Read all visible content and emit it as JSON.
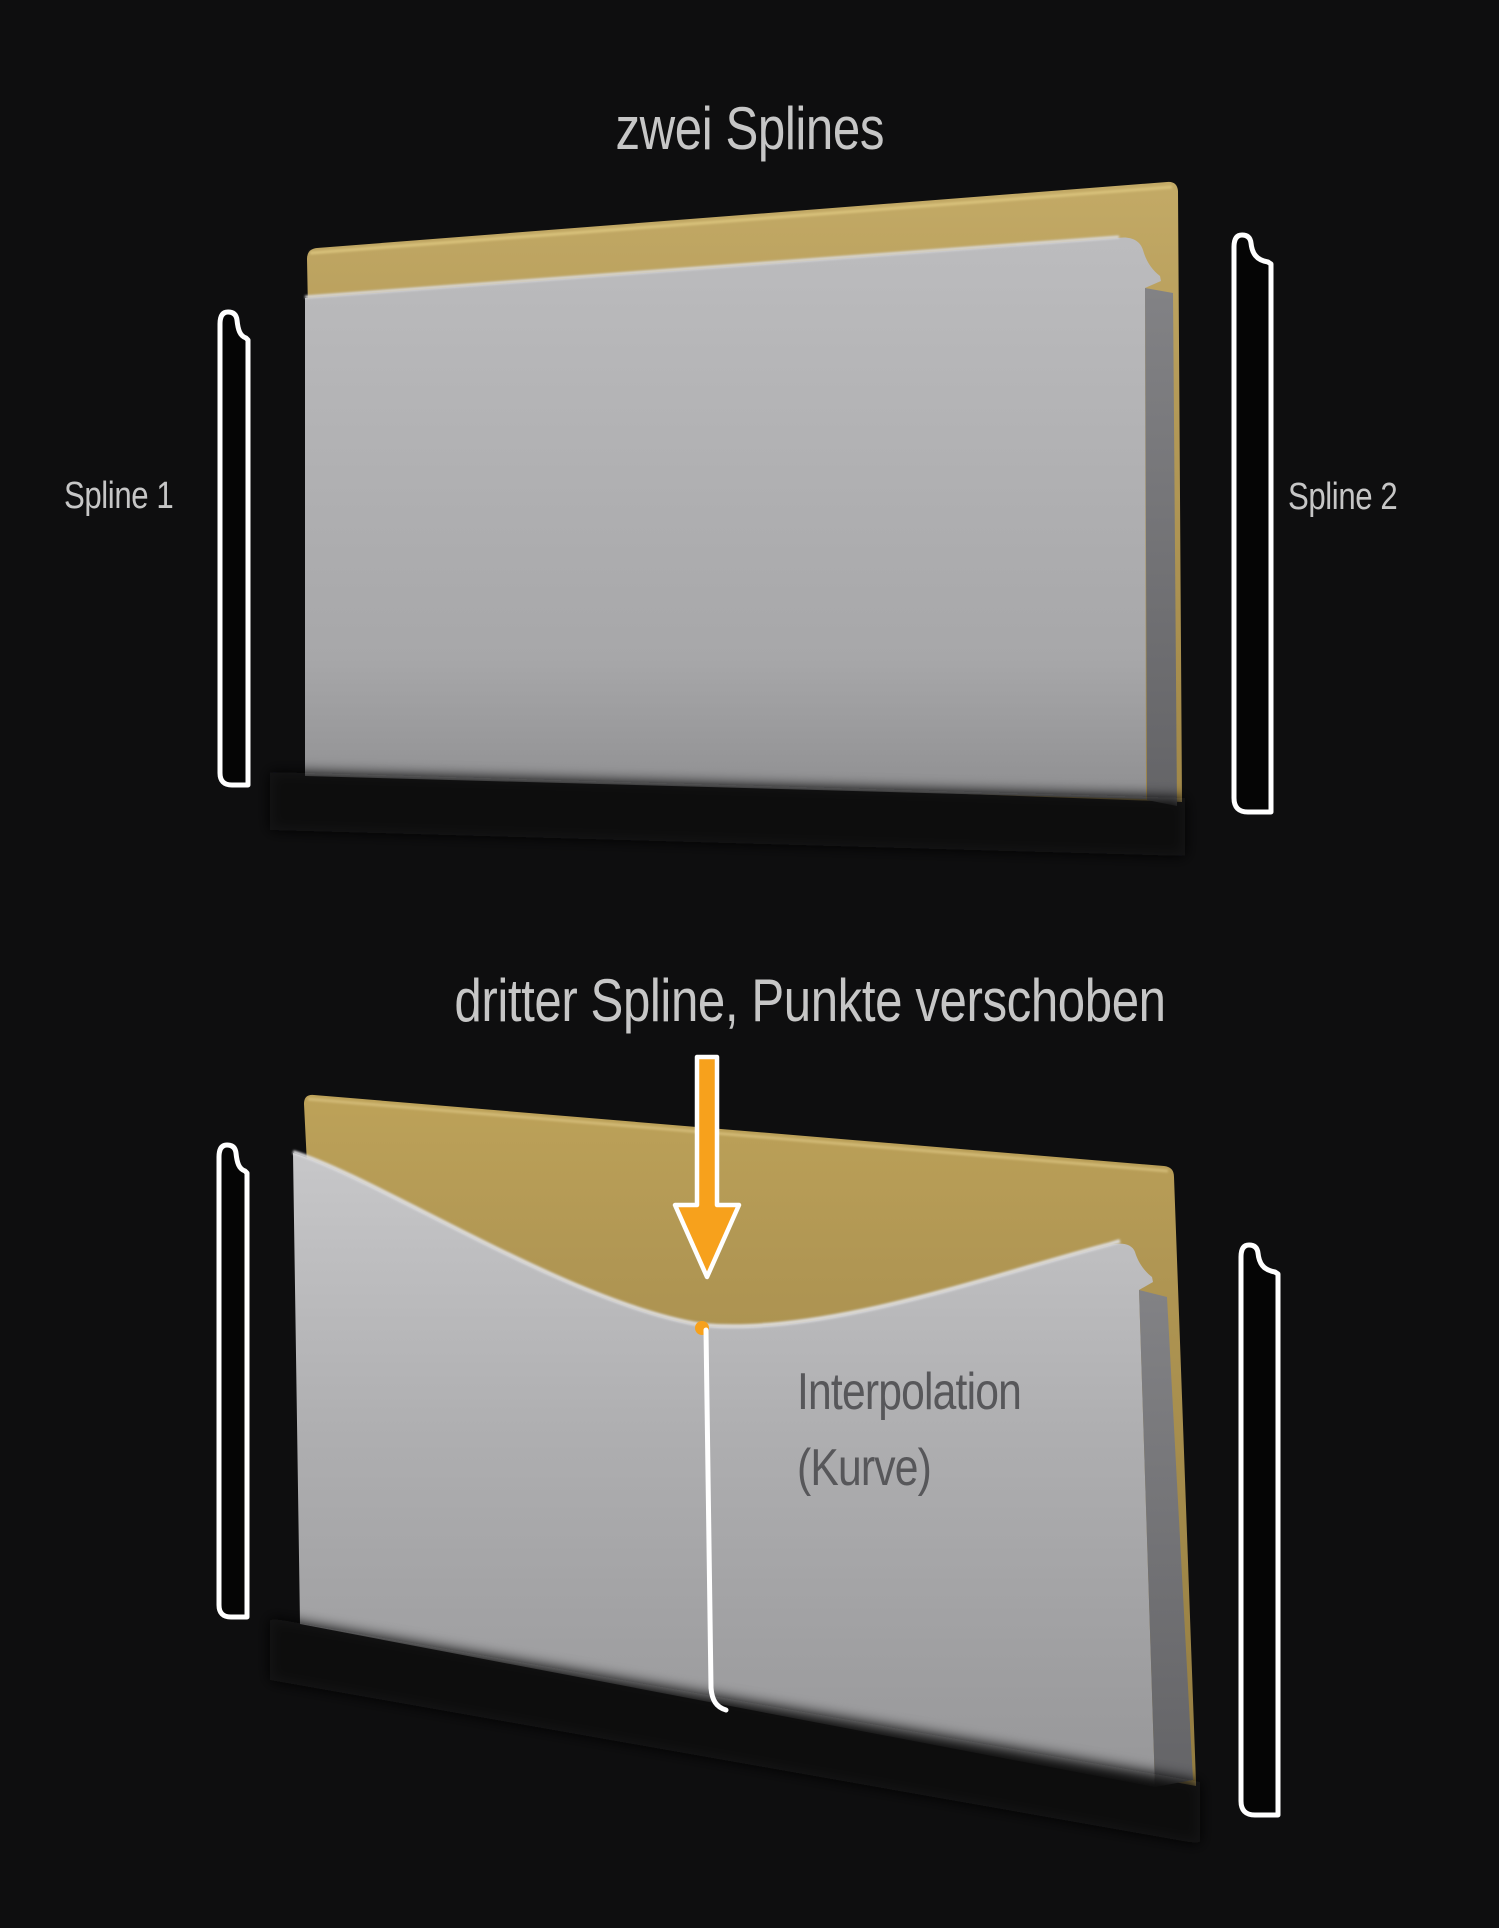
{
  "top_section": {
    "title": "zwei Splines",
    "left_spline_label": "Spline 1",
    "right_spline_label": "Spline 2"
  },
  "bottom_section": {
    "title": "dritter Spline, Punkte verschoben",
    "surface_annotation_line1": "Interpolation",
    "surface_annotation_line2": "(Kurve)"
  },
  "colors": {
    "background": "#0e0e0f",
    "accent_orange": "#F7A11C",
    "gold_plate": "#B49A58",
    "gray_plate": "#ABABAD",
    "outline_white": "#FFFFFF",
    "title_text": "#C6C6C6",
    "annotation_text": "#57575A"
  }
}
